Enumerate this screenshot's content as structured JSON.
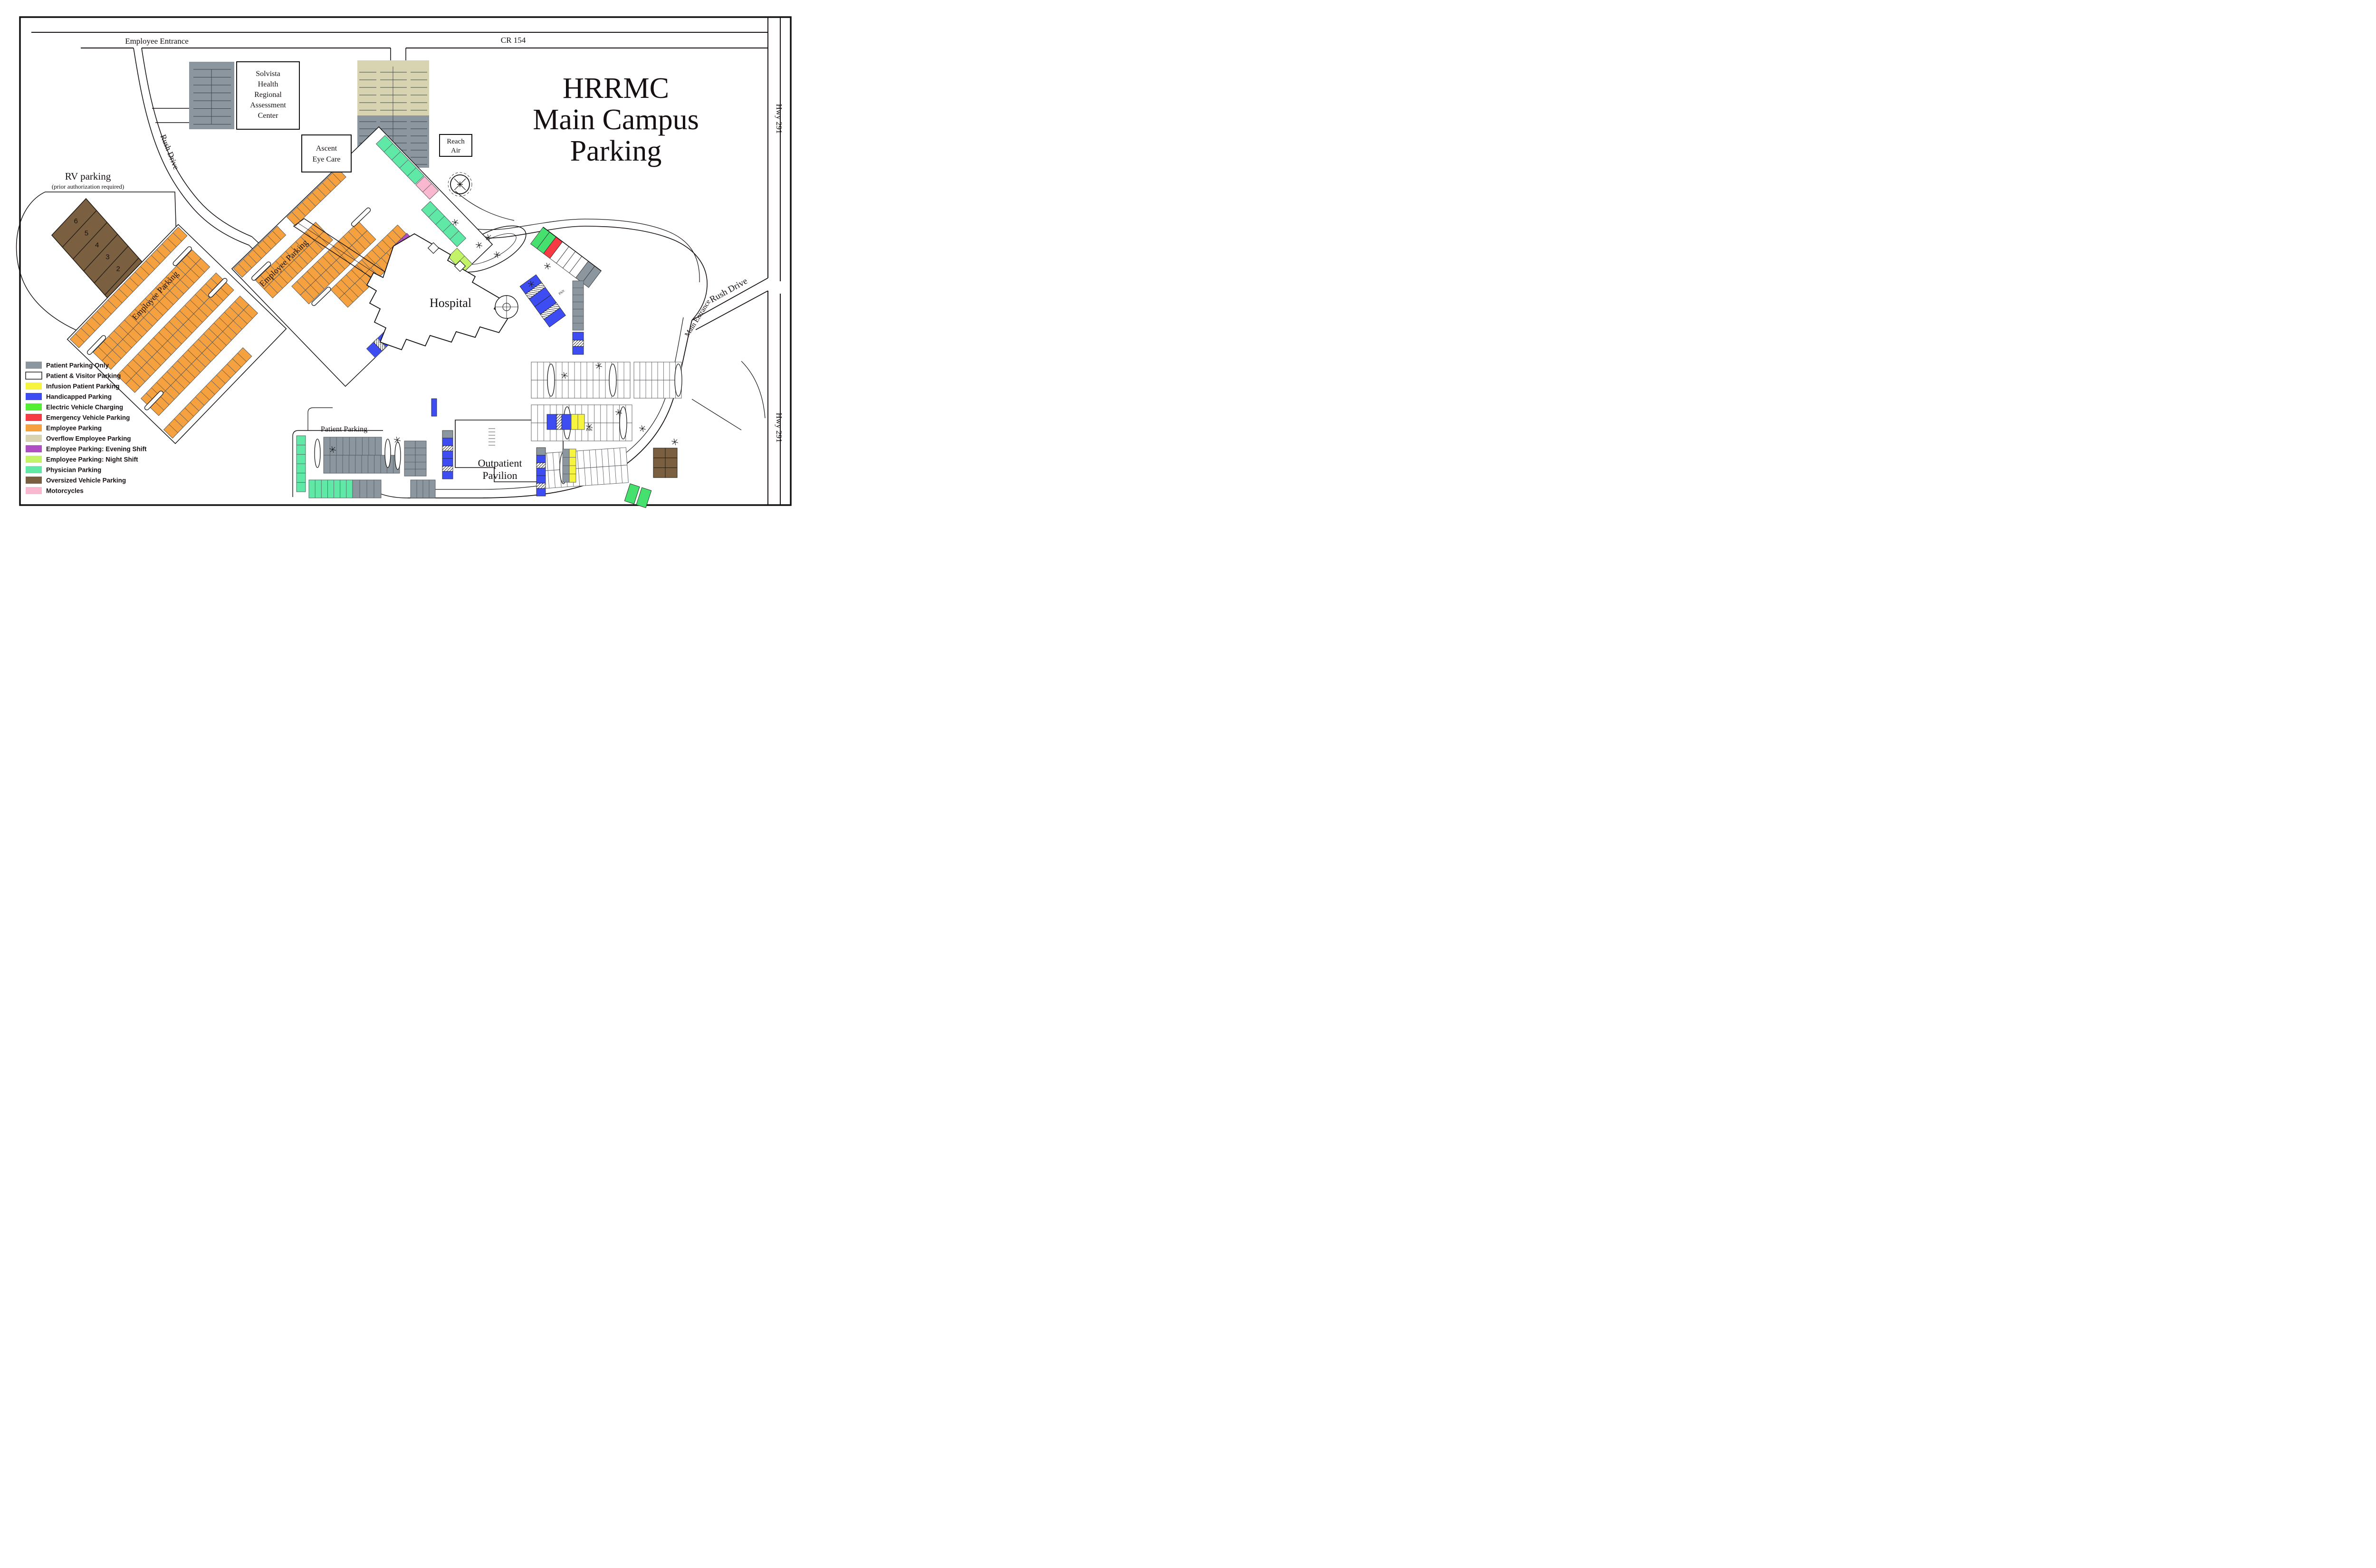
{
  "title": {
    "line1": "HRRMC",
    "line2": "Main Campus",
    "line3": "Parking"
  },
  "roads": {
    "cr154": "CR 154",
    "employee_entrance": "Employee Entrance",
    "hwy291_top": "Hwy 291",
    "hwy291_bottom": "Hwy 291",
    "rush_drive_left": "Rush Drive",
    "rush_drive_right": "Rush Drive",
    "main_entrance": "Main Entrance"
  },
  "buildings": {
    "solvista": [
      "Solvista",
      "Health",
      "Regional",
      "Assessment",
      "Center"
    ],
    "ascent": [
      "Ascent",
      "Eye Care"
    ],
    "reach_air": [
      "Reach",
      "Air"
    ],
    "hospital": "Hospital",
    "outpatient": [
      "Outpatient",
      "Pavilion"
    ]
  },
  "areas": {
    "rv_title": "RV parking",
    "rv_subtitle": "(prior authorization required)",
    "rv_spots": [
      "6",
      "5",
      "4",
      "3",
      "2",
      "1"
    ],
    "employee_parking_left": "Employee Parking",
    "employee_parking_mid": "Employee Parking",
    "patient_parking": "Patient Parking",
    "pan_marker": "PAN"
  },
  "legend": {
    "items": [
      {
        "label": "Patient Parking Only",
        "color": "#8b969e",
        "border": false
      },
      {
        "label": "Patient & Visitor Parking",
        "color": "#ffffff",
        "border": true
      },
      {
        "label": "Infusion Patient Parking",
        "color": "#f7f440",
        "border": false
      },
      {
        "label": "Handicapped Parking",
        "color": "#3d4df2",
        "border": false
      },
      {
        "label": "Electric Vehicle Charging",
        "color": "#54ee33",
        "border": false
      },
      {
        "label": "Emergency Vehicle Parking",
        "color": "#f63b44",
        "border": false
      },
      {
        "label": "Employee Parking",
        "color": "#f6a13f",
        "border": false
      },
      {
        "label": "Overflow Employee Parking",
        "color": "#d8d4b2",
        "border": false
      },
      {
        "label": "Employee Parking: Evening Shift",
        "color": "#b04fc4",
        "border": false
      },
      {
        "label": "Employee Parking: Night Shift",
        "color": "#c3f468",
        "border": false
      },
      {
        "label": "Physician Parking",
        "color": "#5fe8a6",
        "border": false
      },
      {
        "label": "Oversized Vehicle Parking",
        "color": "#7a6041",
        "border": false
      },
      {
        "label": "Motorcycles",
        "color": "#f9b8cf",
        "border": false
      }
    ]
  },
  "colors": {
    "patient_gray": "#8b969e",
    "visitor_white": "#ffffff",
    "infusion_yellow": "#f7f440",
    "handicapped_blue": "#3d4df2",
    "ev_green": "#46e06e",
    "emergency_red": "#f63b44",
    "employee_orange": "#f6a13f",
    "overflow_beige": "#d8d4b2",
    "evening_purple": "#b04fc4",
    "night_green": "#c3f468",
    "physician_mint": "#5fe8a6",
    "oversized_brown": "#7a6041",
    "motorcycle_pink": "#f9b8cf",
    "ink": "#18100f"
  }
}
